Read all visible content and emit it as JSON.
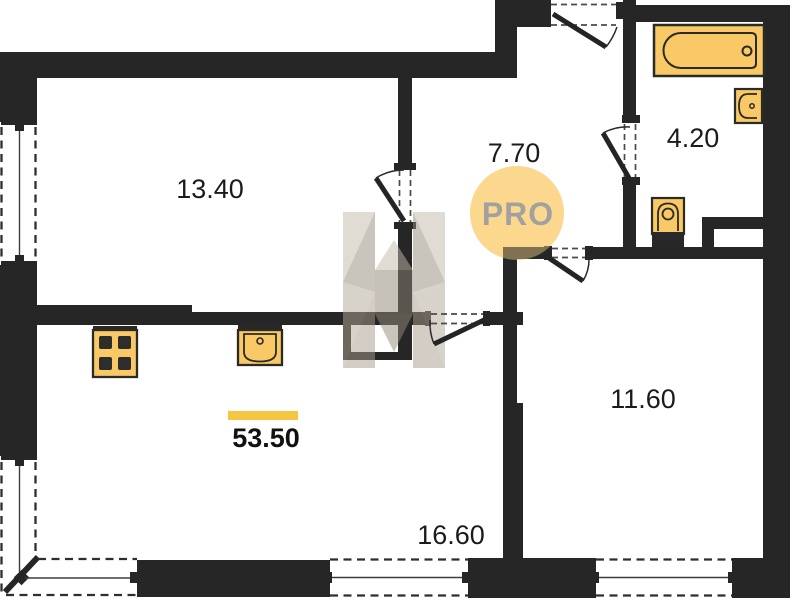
{
  "plan": {
    "badge_text": "PRO",
    "rooms": [
      {
        "name": "living-room",
        "area": "13.40"
      },
      {
        "name": "hallway",
        "area": "7.70"
      },
      {
        "name": "bathroom",
        "area": "4.20"
      },
      {
        "name": "bedroom",
        "area": "11.60"
      },
      {
        "name": "kitchen-living-area",
        "area": "16.60"
      }
    ],
    "total_area": "53.50",
    "fixtures": [
      "bathtub",
      "washbasin",
      "toilet",
      "stove-4-burners",
      "kitchen-sink"
    ],
    "colors": {
      "walls": "#262626",
      "fixture_fill": "#f9c967",
      "badge_fill": "#fbd88e",
      "badge_text": "#a1a19f",
      "total_underline": "#f6c643",
      "watermark_beige": "#a89d8e"
    }
  }
}
